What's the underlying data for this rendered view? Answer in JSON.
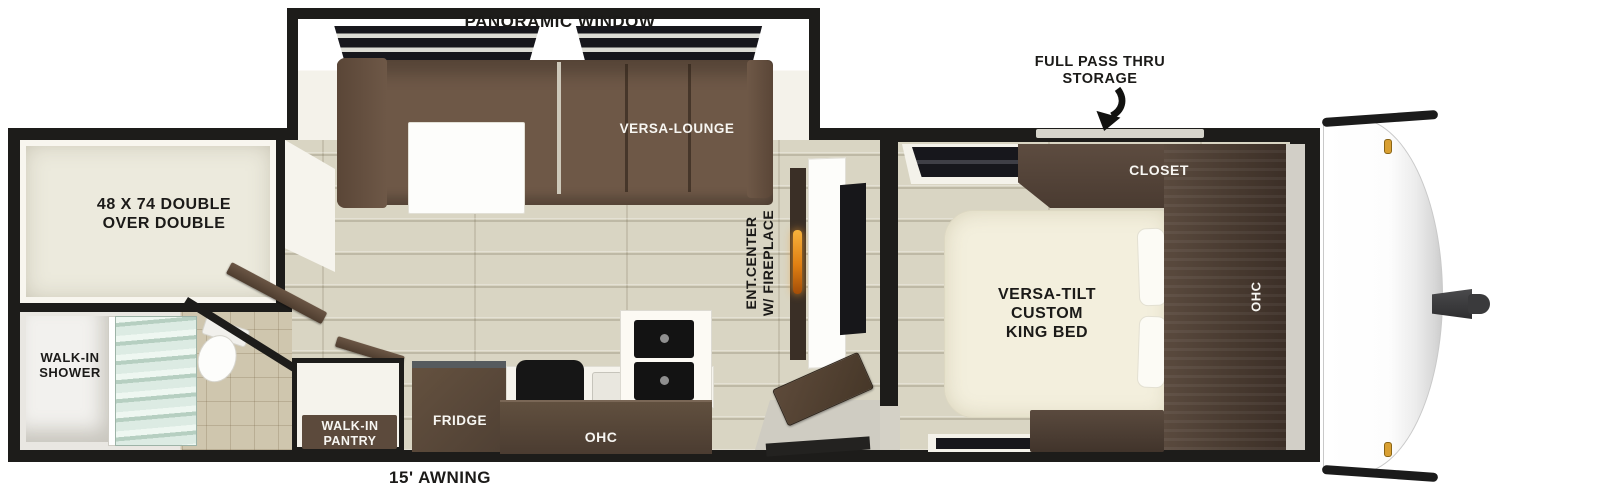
{
  "title": "Travel trailer floor plan",
  "callouts": {
    "panoramic_window": "PANORAMIC WINDOW",
    "full_pass_thru_storage": "FULL PASS THRU\nSTORAGE",
    "awning": "15' AWNING"
  },
  "rooms": {
    "bunk_room": {
      "bed_label": "48 X 74 DOUBLE\nOVER DOUBLE"
    },
    "bathroom": {
      "shower_label": "WALK-IN\nSHOWER"
    },
    "living_room": {
      "lounge_label": "VERSA-LOUNGE",
      "ent_center_label": "ENT.CENTER\nW/ FIREPLACE"
    },
    "kitchen": {
      "pantry_label": "WALK-IN\nPANTRY",
      "fridge_label": "FRIDGE",
      "ohc_label": "OHC"
    },
    "bedroom": {
      "bed_label": "VERSA-TILT\nCUSTOM\nKING BED",
      "closet_label": "CLOSET",
      "ohc_label": "OHC"
    }
  },
  "colors": {
    "wall": "#1d1c1a",
    "floor_wood": "#d9d5c3",
    "sofa_brown": "#6e5847",
    "cabinet_brown": "#4d3e33",
    "bed_cream": "#f3efdd",
    "fireplace_flame": "#e07f12",
    "shower_glass": "#dcebe3",
    "marker_light": "#d9a033"
  }
}
